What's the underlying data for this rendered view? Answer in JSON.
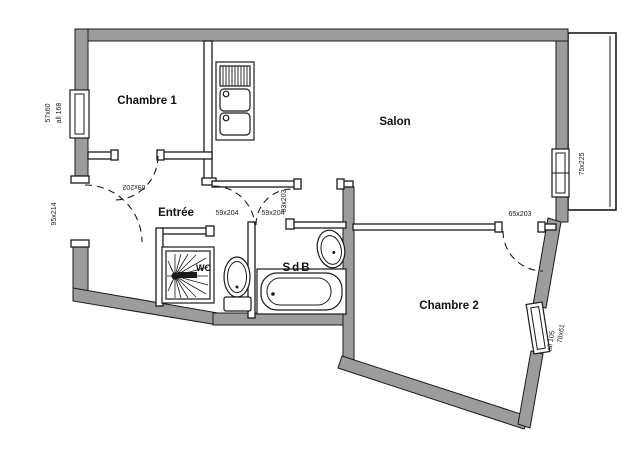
{
  "plan": {
    "type": "apartment-floor-plan",
    "colors": {
      "wall_fill": "#9c9c9c",
      "line": "#1a1a1a",
      "background": "#ffffff"
    },
    "rooms": {
      "chambre1": "Chambre 1",
      "salon": "Salon",
      "entree": "Entrée",
      "sdb": "SdB",
      "wc": "WC",
      "chambre2": "Chambre 2"
    },
    "dims": {
      "chambre1_window": "57x60",
      "chambre1_window_sill": "all 168",
      "entry_door": "95x214",
      "chambre1_door": "69x202",
      "wc_door": "59x204",
      "sdb_door": "59x204",
      "hall_salon_opening": "83x203",
      "chambre2_door": "65x203",
      "salon_window": "75x225",
      "chambre2_window": "78x61",
      "chambre2_window_sill": "all 105"
    },
    "fixtures": {
      "kitchen_sink": "kitchen-sink-icon",
      "shower": "shower-icon",
      "toilet": "toilet-icon",
      "bathtub": "bathtub-icon",
      "washbasin": "washbasin-icon"
    }
  }
}
